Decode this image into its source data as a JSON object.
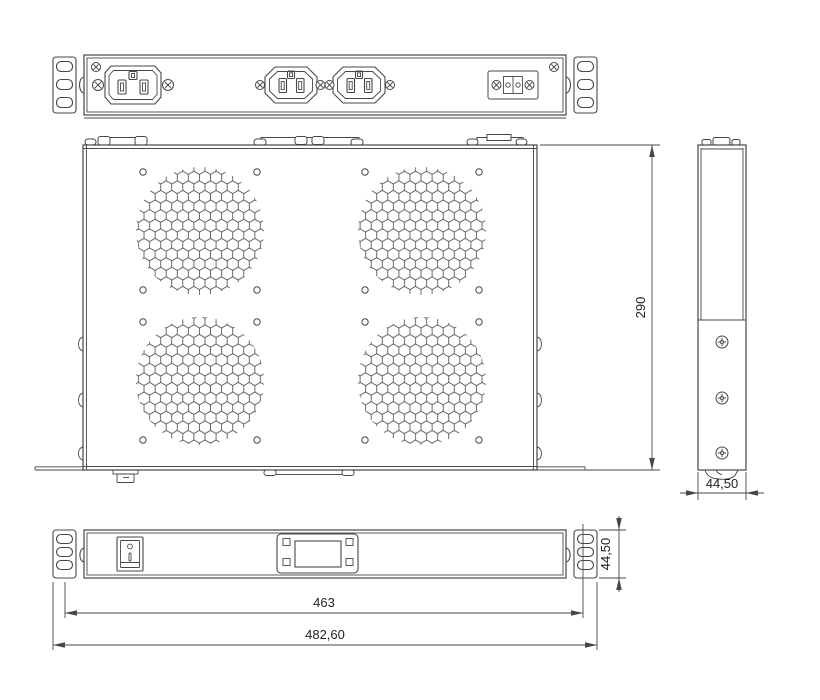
{
  "dimensions": {
    "chassis_depth": "290",
    "side_width": "44,50",
    "panel_height": "44,50",
    "mounting_width": "463",
    "overall_width": "482,60"
  },
  "colors": {
    "line": "#474747",
    "text": "#1e1e1e",
    "background": "#ffffff"
  }
}
